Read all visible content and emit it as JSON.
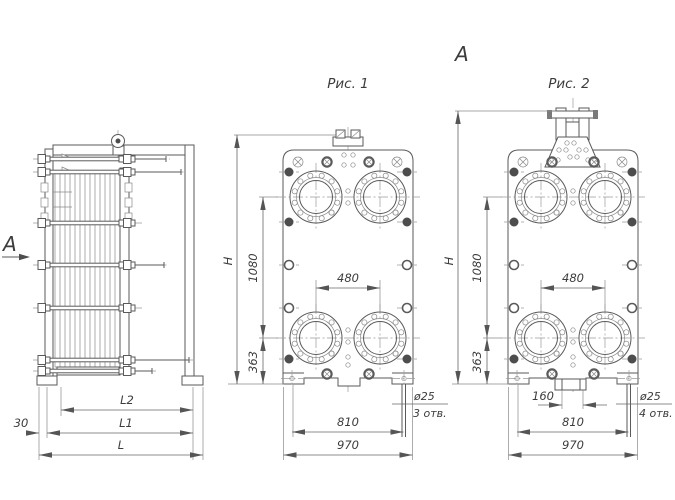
{
  "side": {
    "view_marker": "А",
    "dim_l": "L",
    "dim_l1": "L1",
    "dim_l2": "L2",
    "dim_30": "30"
  },
  "fig1": {
    "title": "Рис. 1",
    "dim_h": "H",
    "dim_1080": "1080",
    "dim_363": "363",
    "dim_480": "480",
    "dim_810": "810",
    "dim_970": "970",
    "hole_dia": "ø25",
    "hole_count": "3 отв."
  },
  "fig2": {
    "title": "Рис. 2",
    "view_marker": "А",
    "dim_h": "H",
    "dim_1080": "1080",
    "dim_363": "363",
    "dim_480": "480",
    "dim_160": "160",
    "dim_810": "810",
    "dim_970": "970",
    "hole_dia": "ø25",
    "hole_count": "4 отв."
  },
  "colors": {
    "main_line": "#5a5a5a",
    "thin_line": "#8a8a8a",
    "center_line": "#9a9a9a",
    "dim_line": "#666666",
    "dark_fill": "#4d4d4d",
    "text": "#3c3c3c",
    "background": "#ffffff"
  }
}
